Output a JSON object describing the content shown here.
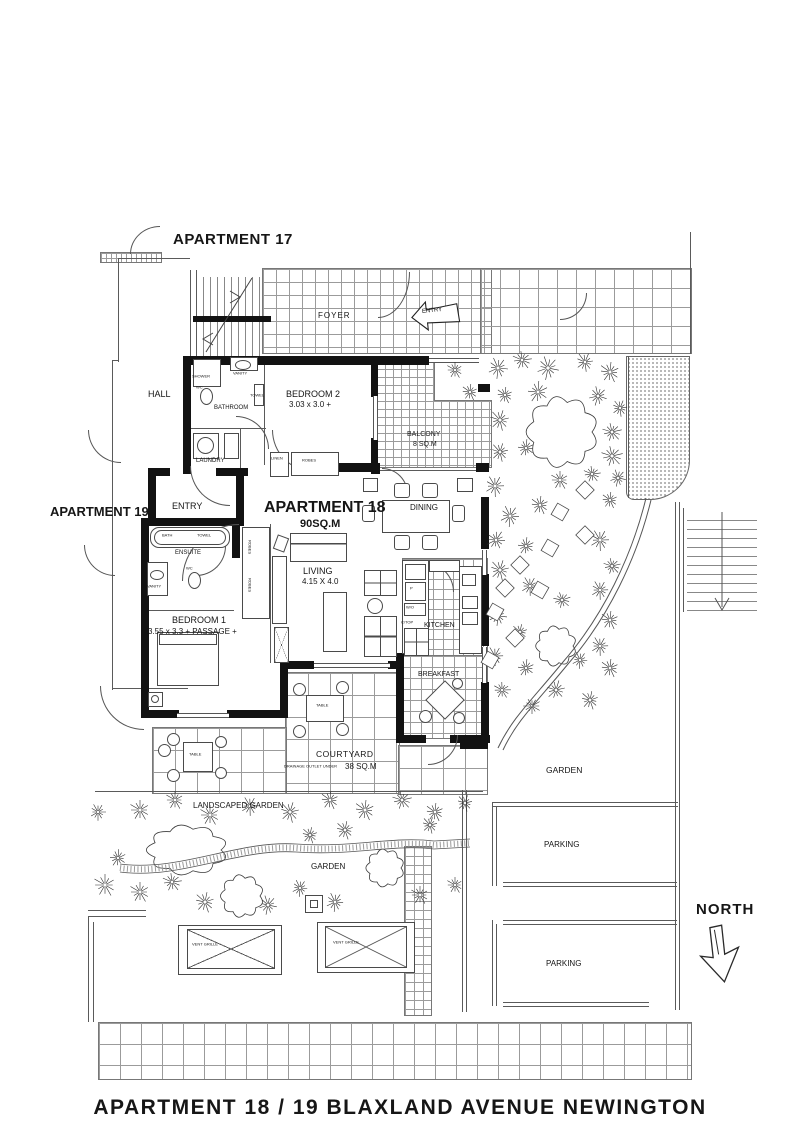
{
  "title": "APARTMENT 18 / 19  BLAXLAND  AVENUE  NEWINGTON",
  "apartments": {
    "apt17": "APARTMENT 17",
    "apt19": "APARTMENT 19",
    "apt18_name": "APARTMENT 18",
    "apt18_area": "90SQ.M"
  },
  "rooms": {
    "foyer": "FOYER",
    "hall": "HALL",
    "entry_top": "ENTRY",
    "entry_19": "ENTRY",
    "bedroom2_name": "BEDROOM 2",
    "bedroom2_dims": "3.03 x 3.0 +",
    "bathroom": "BATHROOM",
    "laundry": "LAUNDRY",
    "balcony_name": "BALCONY",
    "balcony_area": "8 SQ.M",
    "dining": "DINING",
    "living_name": "LIVING",
    "living_dims": "4.15 X 4.0",
    "ensuite": "ENSUITE",
    "bedroom1_name": "BEDROOM 1",
    "bedroom1_dims": "3.55 x 3.3 + PASSAGE +",
    "kitchen": "KITCHEN",
    "breakfast": "BREAKFAST",
    "courtyard_name": "COURTYARD",
    "courtyard_area": "38 SQ.M",
    "courtyard_note": "DRAINAGE OUTLET UNDER",
    "robes": "ROBES",
    "linen": "LINEN",
    "table": "TABLE"
  },
  "fixtures": {
    "shower": "SHOWER",
    "vanity": "VANITY",
    "towel": "TOWEL",
    "wc": "WC",
    "bath": "BATH",
    "pantry": "P",
    "wall_oven": "W/O",
    "cooktop": "C/TOP"
  },
  "outdoor": {
    "landscaped_garden": "LANDSCAPED GARDEN",
    "garden_left": "GARDEN",
    "garden_right": "GARDEN",
    "parking_upper": "PARKING",
    "parking_lower": "PARKING",
    "vent_grille": "VENT GRILLE",
    "north": "NORTH"
  },
  "colors": {
    "ink": "#161616",
    "line": "#5a5a5a",
    "wall": "#121212"
  }
}
